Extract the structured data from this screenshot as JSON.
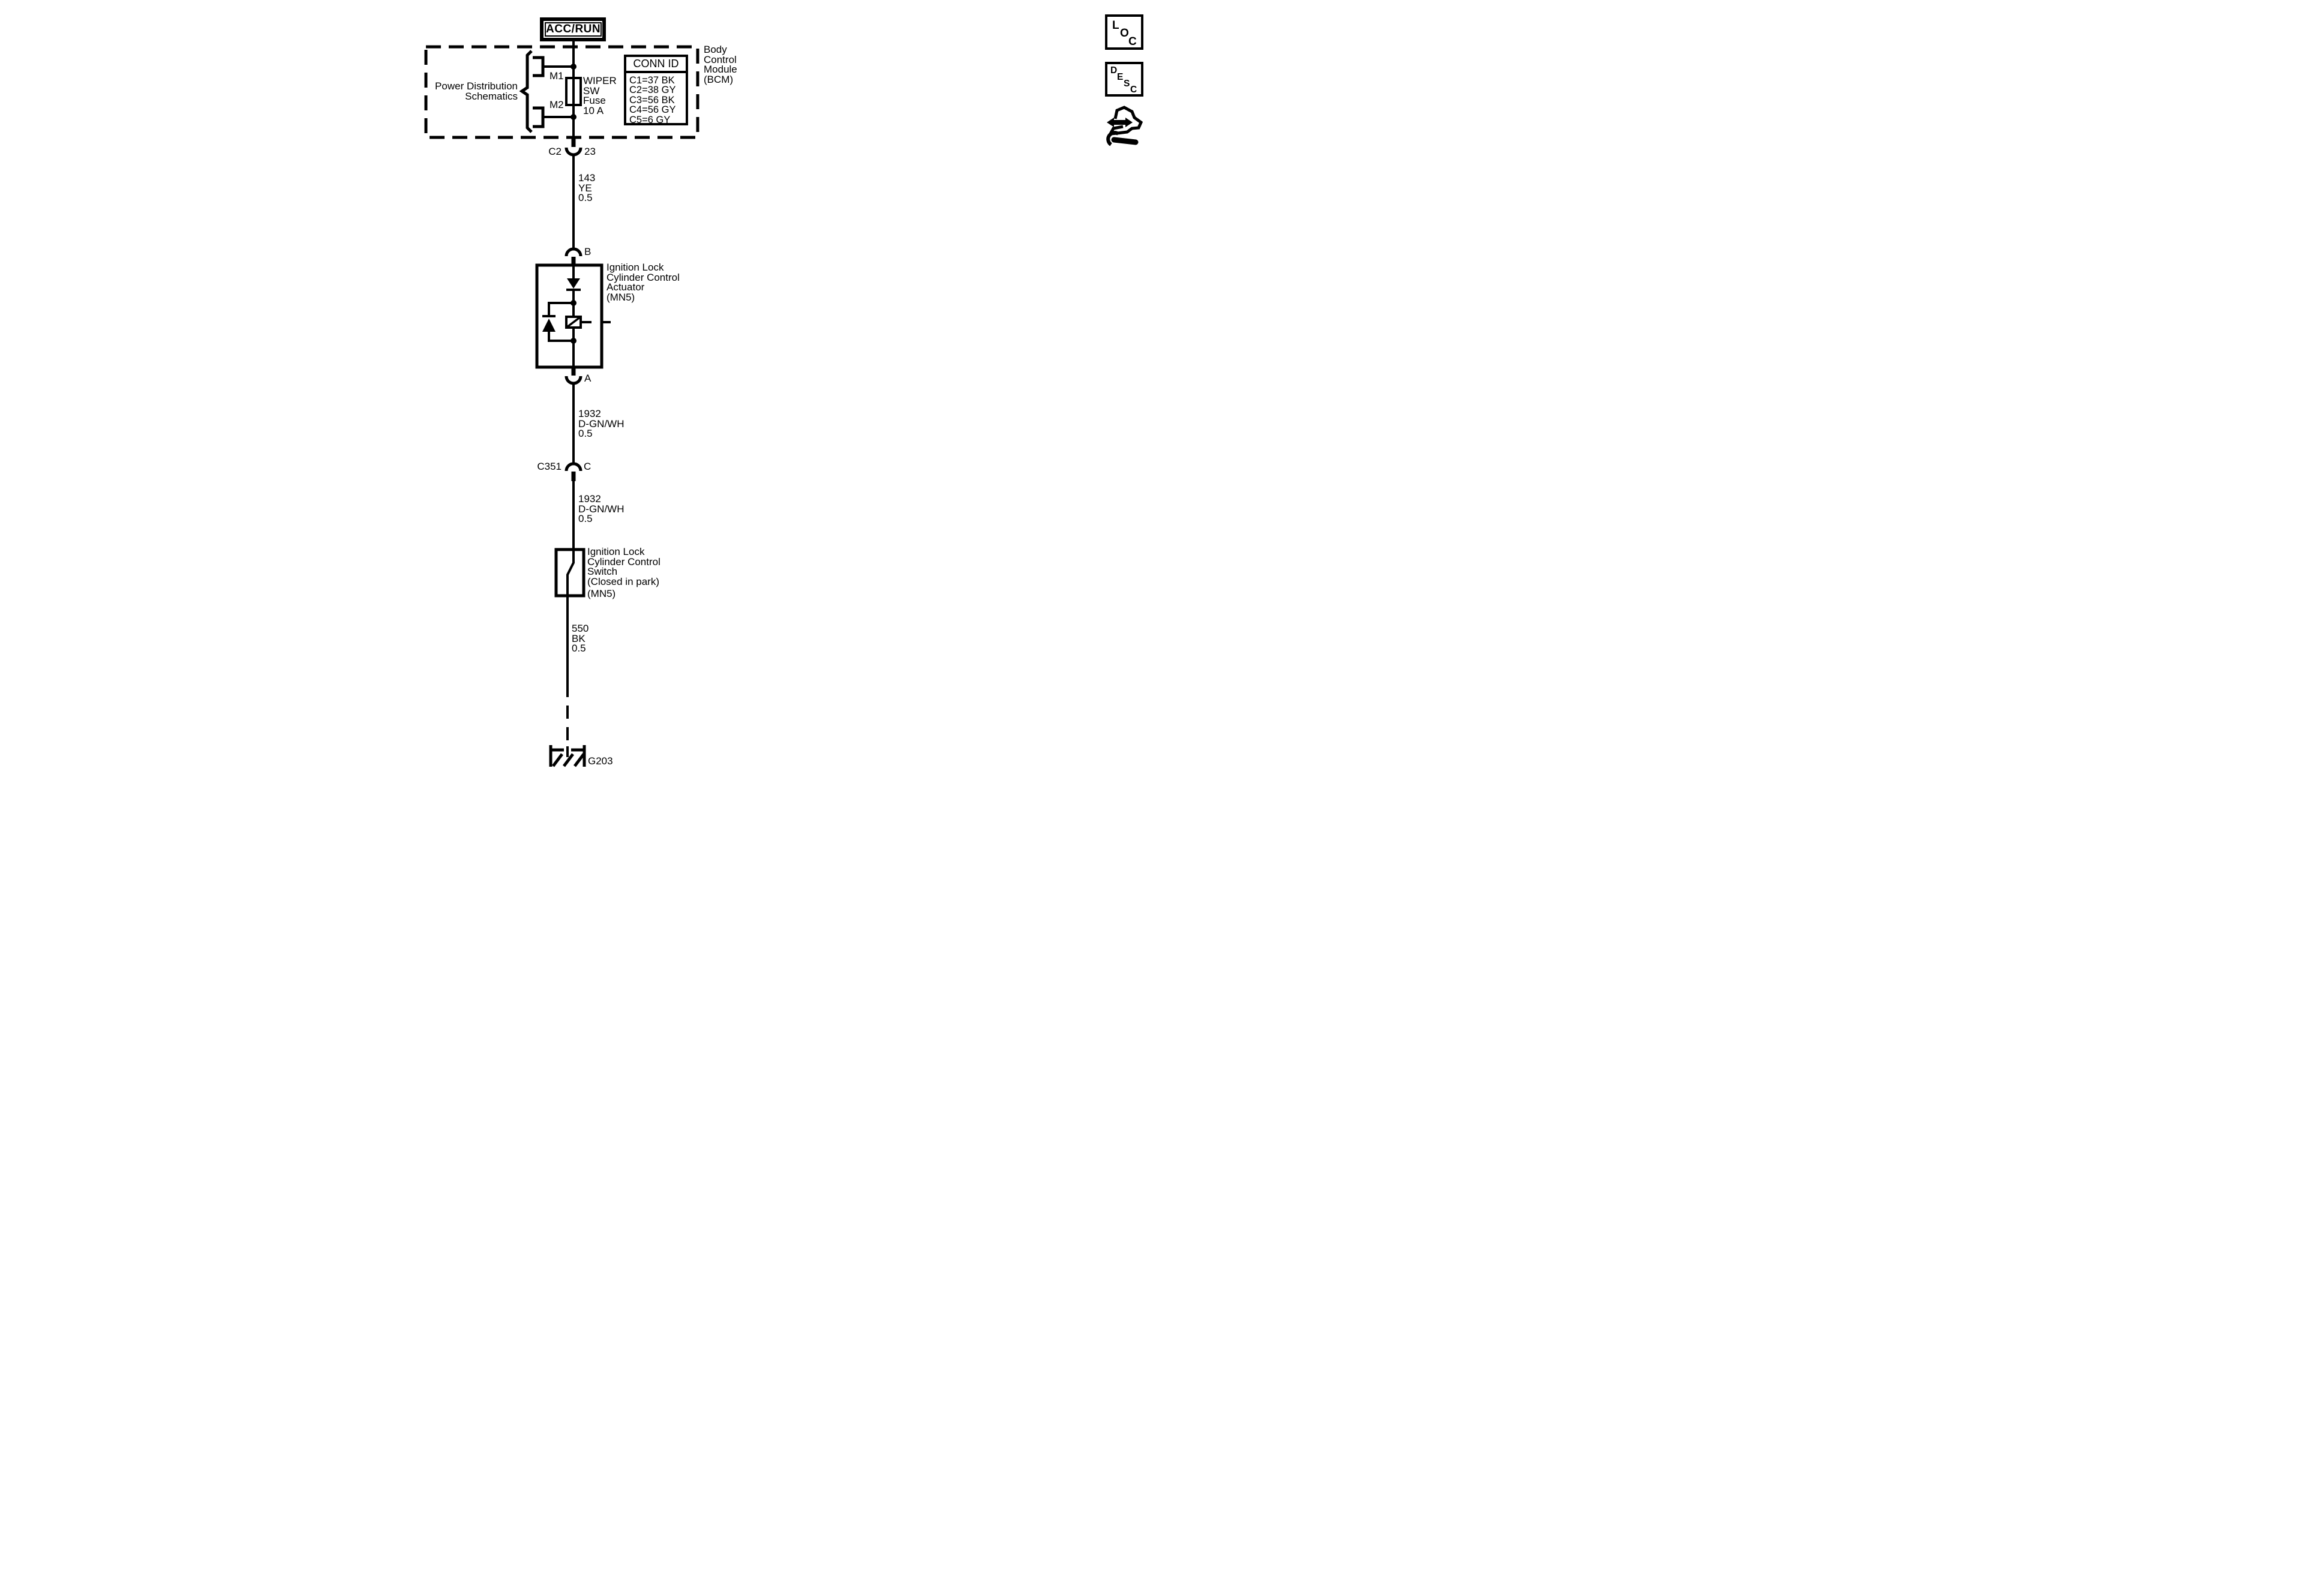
{
  "palette": {
    "ink": "#000000",
    "paper": "#ffffff"
  },
  "power_box": {
    "label": "ACC/RUN"
  },
  "bcm": {
    "schematic_ref_line1": "Power Distribution",
    "schematic_ref_line2": "Schematics",
    "feed_m1": "M1",
    "feed_m2": "M2",
    "fuse_line1": "WIPER",
    "fuse_line2": "SW",
    "fuse_line3": "Fuse",
    "fuse_line4": "10 A",
    "conn_table": {
      "header": "CONN ID",
      "rows": [
        "C1=37 BK",
        "C2=38 GY",
        "C3=56 BK",
        "C4=56 GY",
        "C5=6 GY"
      ]
    },
    "name_line1": "Body",
    "name_line2": "Control",
    "name_line3": "Module",
    "name_line4": "(BCM)"
  },
  "connectors": {
    "c2": {
      "name": "C2",
      "pin": "23"
    },
    "b": {
      "pin": "B"
    },
    "a": {
      "pin": "A"
    },
    "c351": {
      "name": "C351",
      "pin": "C"
    }
  },
  "wires": {
    "w143": {
      "circuit": "143",
      "color": "YE",
      "gauge": "0.5"
    },
    "w1932a": {
      "circuit": "1932",
      "color": "D-GN/WH",
      "gauge": "0.5"
    },
    "w1932b": {
      "circuit": "1932",
      "color": "D-GN/WH",
      "gauge": "0.5"
    },
    "w550": {
      "circuit": "550",
      "color": "BK",
      "gauge": "0.5"
    }
  },
  "actuator": {
    "line1": "Ignition Lock",
    "line2": "Cylinder Control",
    "line3": "Actuator",
    "line4": "(MN5)"
  },
  "switch": {
    "line1": "Ignition Lock",
    "line2": "Cylinder Control",
    "line3": "Switch",
    "line4": "(Closed in park)",
    "line5": "(MN5)"
  },
  "ground": {
    "label": "G203"
  },
  "header_icons": {
    "loc_letters": [
      "L",
      "O",
      "C"
    ],
    "desc_letters": [
      "D",
      "E",
      "S",
      "C"
    ]
  }
}
